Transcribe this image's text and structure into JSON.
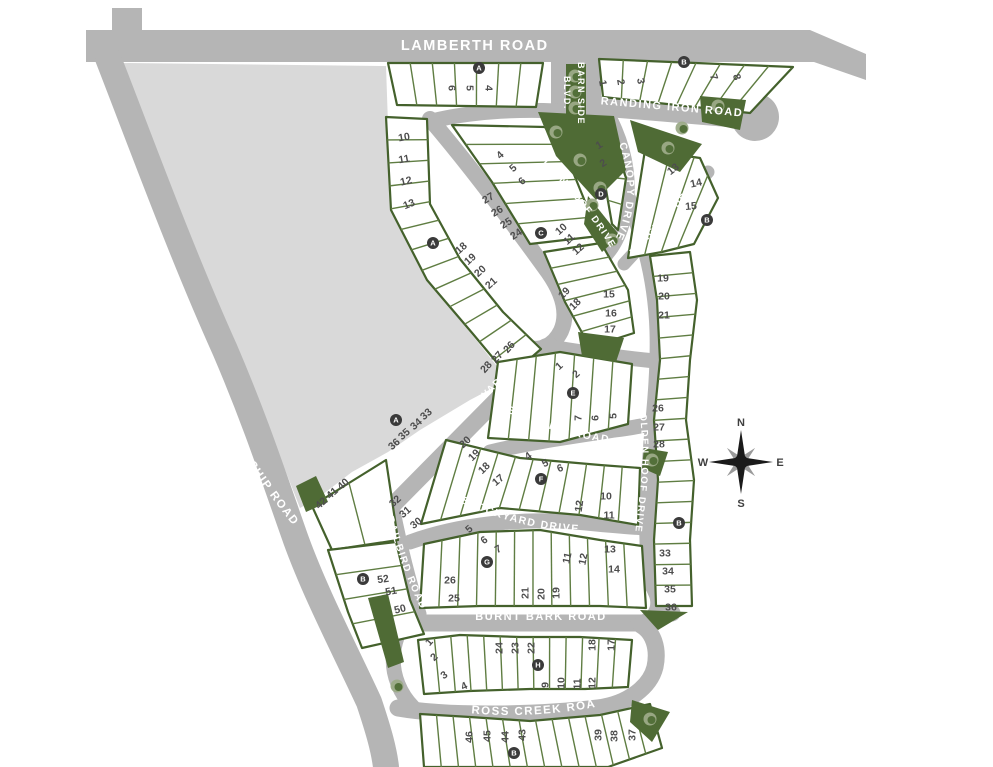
{
  "map": {
    "title": "residential community site plan",
    "compass": {
      "n": "N",
      "e": "E",
      "s": "S",
      "w": "W"
    },
    "colors": {
      "road": "#b5b5b5",
      "open_space": "#d9d9d9",
      "lot_fill": "#ffffff",
      "lot_line": "#5f7d42",
      "block_edge": "#44612c",
      "green_space": "#4f6b35",
      "tree_light": "#9cab88",
      "tree_dark": "#53703a",
      "marker_bg": "#3a3a3a",
      "number_text": "#4d4d4d",
      "road_text": "#ffffff",
      "compass_dark": "#1a1a1a",
      "compass_gray": "#9a9a9a"
    },
    "roads": [
      {
        "id": "lamberth",
        "label": "LAMBERTH ROAD"
      },
      {
        "id": "friendship",
        "label": "FRIENDSHIP ROAD"
      },
      {
        "id": "barnside",
        "label": "BARN SIDE BLVD.",
        "line1": "BARN SIDE",
        "line2": "BLVD."
      },
      {
        "id": "branding",
        "label": "BRANDING IRON ROAD"
      },
      {
        "id": "canopy",
        "label": "CANOPY DRIVE"
      },
      {
        "id": "bangtail",
        "label": "BANGTAIL DR."
      },
      {
        "id": "goldenhoof-upper",
        "label": "GOLDEN HOOF DRIVE"
      },
      {
        "id": "goldenhoof-lower",
        "label": "GOLDEN HOOF DRIVE"
      },
      {
        "id": "trailside",
        "label": "TRAILSIDE DRIVE"
      },
      {
        "id": "brushwood",
        "label": "BRUSHWOOD BOULEVARD"
      },
      {
        "id": "bullwhip",
        "label": "BULLWHIP ROAD"
      },
      {
        "id": "stockyard",
        "label": "STOCKYARD DRIVE"
      },
      {
        "id": "railbird",
        "label": "RAILBIRD ROAD"
      },
      {
        "id": "burntbark",
        "label": "BURNT BARK ROAD"
      },
      {
        "id": "crosscreek",
        "label": "CROSS CREEK ROAD"
      }
    ],
    "lots": [
      [
        "6",
        452,
        88,
        90
      ],
      [
        "5",
        470,
        88,
        90
      ],
      [
        "4",
        489,
        88,
        90
      ],
      [
        "1",
        603,
        83,
        80
      ],
      [
        "2",
        621,
        82,
        80
      ],
      [
        "3",
        641,
        81,
        80
      ],
      [
        "7",
        714,
        77,
        72
      ],
      [
        "8",
        737,
        77,
        72
      ],
      [
        "10",
        404,
        137,
        -10
      ],
      [
        "11",
        404,
        159,
        -10
      ],
      [
        "12",
        406,
        181,
        -14
      ],
      [
        "13",
        409,
        204,
        -22
      ],
      [
        "4",
        500,
        155,
        -42
      ],
      [
        "5",
        513,
        168,
        -42
      ],
      [
        "6",
        522,
        181,
        -42
      ],
      [
        "27",
        488,
        198,
        -30
      ],
      [
        "26",
        497,
        211,
        -30
      ],
      [
        "25",
        506,
        223,
        -32
      ],
      [
        "24",
        516,
        234,
        -34
      ],
      [
        "1",
        599,
        145,
        -32
      ],
      [
        "2",
        603,
        163,
        -32
      ],
      [
        "13",
        673,
        169,
        -38
      ],
      [
        "14",
        696,
        183,
        -12
      ],
      [
        "15",
        691,
        206,
        -5
      ],
      [
        "18",
        461,
        248,
        -42
      ],
      [
        "19",
        470,
        259,
        -42
      ],
      [
        "20",
        480,
        271,
        -42
      ],
      [
        "21",
        491,
        283,
        -42
      ],
      [
        "10",
        561,
        229,
        -42
      ],
      [
        "11",
        569,
        239,
        -42
      ],
      [
        "12",
        578,
        249,
        -42
      ],
      [
        "19",
        564,
        293,
        -44
      ],
      [
        "18",
        575,
        304,
        -44
      ],
      [
        "15",
        609,
        294,
        0
      ],
      [
        "16",
        611,
        313,
        0
      ],
      [
        "17",
        610,
        329,
        0
      ],
      [
        "19",
        663,
        278,
        0
      ],
      [
        "20",
        664,
        296,
        0
      ],
      [
        "21",
        664,
        315,
        0
      ],
      [
        "26",
        658,
        408,
        0
      ],
      [
        "27",
        659,
        427,
        0
      ],
      [
        "28",
        659,
        444,
        0
      ],
      [
        "33",
        665,
        553,
        0
      ],
      [
        "34",
        668,
        571,
        0
      ],
      [
        "35",
        670,
        589,
        0
      ],
      [
        "36",
        671,
        607,
        0
      ],
      [
        "26",
        509,
        347,
        -48
      ],
      [
        "27",
        497,
        357,
        -48
      ],
      [
        "28",
        486,
        367,
        -48
      ],
      [
        "1",
        559,
        366,
        -42
      ],
      [
        "2",
        576,
        374,
        -42
      ],
      [
        "7",
        578,
        418,
        -90
      ],
      [
        "6",
        595,
        418,
        -90
      ],
      [
        "5",
        613,
        416,
        -90
      ],
      [
        "33",
        426,
        414,
        -42
      ],
      [
        "34",
        416,
        424,
        -42
      ],
      [
        "35",
        404,
        434,
        -42
      ],
      [
        "36",
        394,
        444,
        -42
      ],
      [
        "32",
        395,
        501,
        -42
      ],
      [
        "31",
        405,
        512,
        -42
      ],
      [
        "30",
        416,
        523,
        -38
      ],
      [
        "40",
        343,
        484,
        -42
      ],
      [
        "41",
        332,
        493,
        -42
      ],
      [
        "42",
        321,
        503,
        -42
      ],
      [
        "20",
        465,
        442,
        -44
      ],
      [
        "19",
        474,
        455,
        -44
      ],
      [
        "18",
        484,
        468,
        -44
      ],
      [
        "17",
        498,
        480,
        -40
      ],
      [
        "4",
        528,
        456,
        -36
      ],
      [
        "5",
        545,
        463,
        -28
      ],
      [
        "6",
        560,
        468,
        -22
      ],
      [
        "12",
        579,
        506,
        -82
      ],
      [
        "10",
        606,
        496,
        0
      ],
      [
        "11",
        609,
        515,
        0
      ],
      [
        "5",
        469,
        529,
        -42
      ],
      [
        "6",
        484,
        540,
        -36
      ],
      [
        "7",
        498,
        549,
        -30
      ],
      [
        "26",
        450,
        580,
        0
      ],
      [
        "25",
        454,
        598,
        0
      ],
      [
        "21",
        525,
        593,
        -90
      ],
      [
        "20",
        541,
        594,
        -90
      ],
      [
        "19",
        556,
        593,
        -90
      ],
      [
        "11",
        567,
        558,
        -78
      ],
      [
        "12",
        583,
        559,
        -78
      ],
      [
        "13",
        610,
        549,
        0
      ],
      [
        "14",
        614,
        569,
        0
      ],
      [
        "52",
        383,
        579,
        -8
      ],
      [
        "51",
        391,
        591,
        -10
      ],
      [
        "50",
        400,
        609,
        -14
      ],
      [
        "1",
        429,
        642,
        -48
      ],
      [
        "2",
        434,
        657,
        -42
      ],
      [
        "3",
        444,
        675,
        -35
      ],
      [
        "4",
        464,
        686,
        -25
      ],
      [
        "24",
        499,
        648,
        -90
      ],
      [
        "23",
        515,
        648,
        -90
      ],
      [
        "22",
        531,
        648,
        -90
      ],
      [
        "18",
        592,
        645,
        -90
      ],
      [
        "17",
        611,
        645,
        -90
      ],
      [
        "9",
        545,
        685,
        -90
      ],
      [
        "10",
        561,
        683,
        -90
      ],
      [
        "11",
        577,
        684,
        -90
      ],
      [
        "12",
        592,
        683,
        -90
      ],
      [
        "46",
        469,
        737,
        -90
      ],
      [
        "45",
        487,
        736,
        -90
      ],
      [
        "44",
        505,
        737,
        -90
      ],
      [
        "43",
        522,
        735,
        -90
      ],
      [
        "39",
        598,
        735,
        -90
      ],
      [
        "38",
        614,
        736,
        -90
      ],
      [
        "37",
        632,
        735,
        -90
      ]
    ],
    "markers": [
      [
        "A",
        479,
        68
      ],
      [
        "B",
        684,
        62
      ],
      [
        "A",
        433,
        243
      ],
      [
        "C",
        541,
        233
      ],
      [
        "D",
        601,
        194
      ],
      [
        "B",
        707,
        220
      ],
      [
        "E",
        573,
        393
      ],
      [
        "A",
        396,
        420
      ],
      [
        "F",
        541,
        479
      ],
      [
        "G",
        487,
        562
      ],
      [
        "B",
        363,
        579
      ],
      [
        "B",
        679,
        523
      ],
      [
        "H",
        538,
        665
      ],
      [
        "B",
        514,
        753
      ]
    ]
  }
}
